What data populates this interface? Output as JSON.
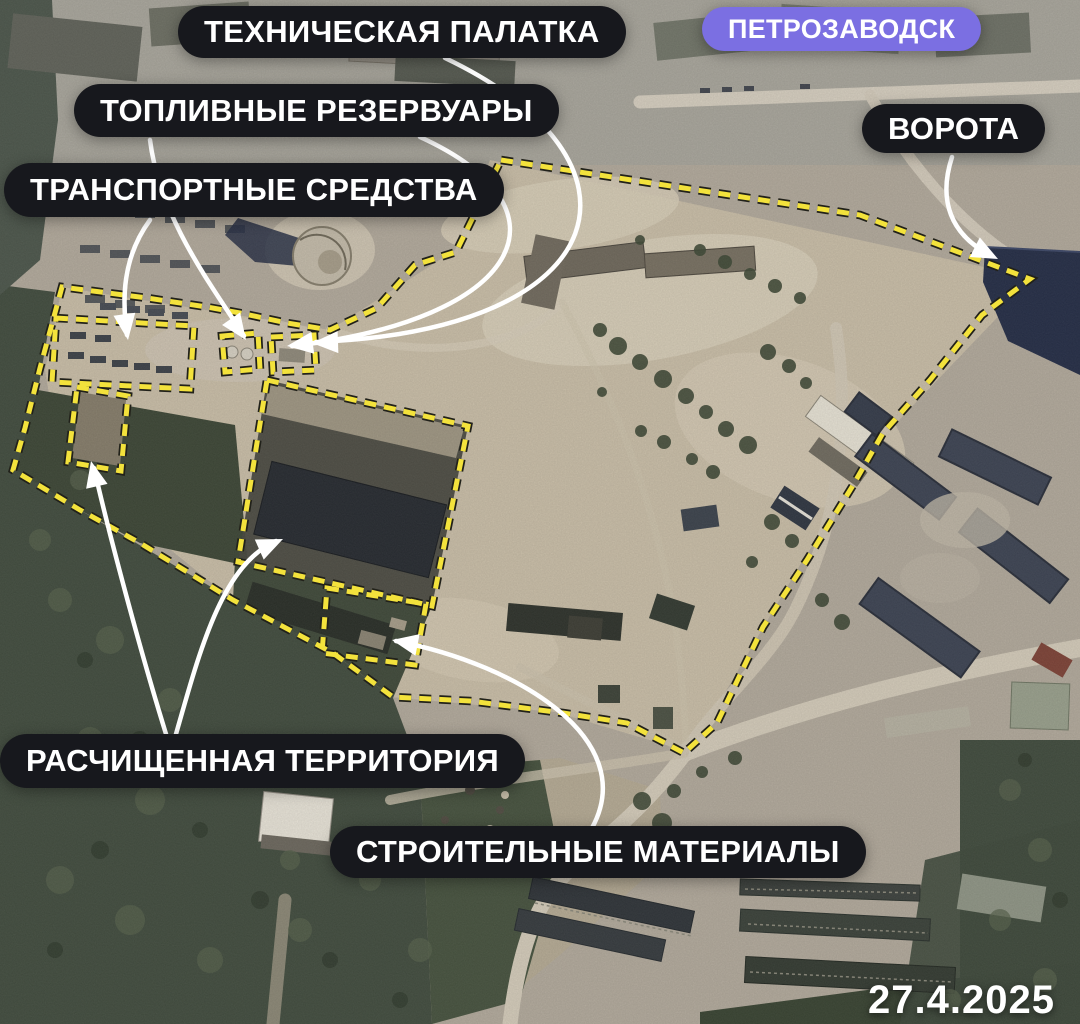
{
  "city_badge": "ПЕТРОЗАВОДСК",
  "annotations": {
    "tent": "ТЕХНИЧЕСКАЯ ПАЛАТКА",
    "fuel": "ТОПЛИВНЫЕ РЕЗЕРВУАРЫ",
    "vehicles": "ТРАНСПОРТНЫЕ СРЕДСТВА",
    "gate": "ВОРОТА",
    "cleared": "РАСЧИЩЕННАЯ ТЕРРИТОРИЯ",
    "materials": "СТРОИТЕЛЬНЫЕ МАТЕРИАЛЫ"
  },
  "date_stamp": "27.4.2025",
  "colors": {
    "boundary_yellow": "#f3e23c",
    "boundary_edge": "#21211a",
    "label_bg": "#17181d",
    "label_text": "#ffffff",
    "city_badge_bg": "#7b6fe2",
    "arrow_white": "#ffffff"
  }
}
